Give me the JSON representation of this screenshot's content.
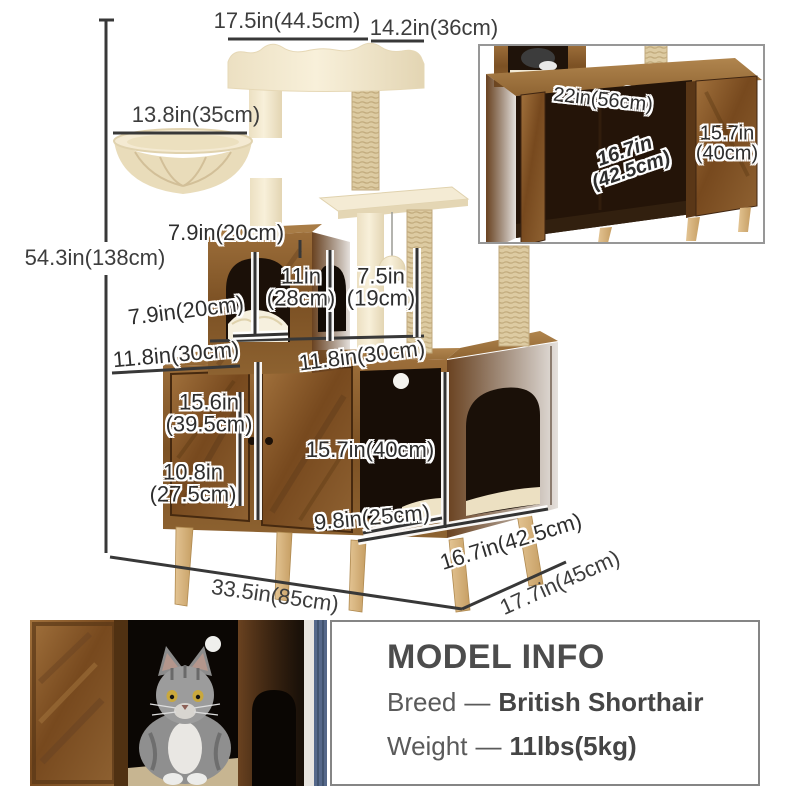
{
  "diagram": {
    "dimensions": {
      "top_platform_width": "17.5in(44.5cm)",
      "top_platform_depth": "14.2in(36cm)",
      "hammock_width": "13.8in(35cm)",
      "total_height": "54.3in(138cm)",
      "condo_height": "7.9in(20cm)",
      "condo_interior_height": {
        "line1": "11in",
        "line2": "(28cm)"
      },
      "post_section_height": {
        "line1": "7.5in",
        "line2": "(19cm)"
      },
      "condo_depth": "7.9in(20cm)",
      "top_depth_left": "11.8in(30cm)",
      "top_depth_right": "11.8in(30cm)",
      "left_door_height": {
        "line1": "15.6in",
        "line2": "(39.5cm)"
      },
      "lower_section_height": {
        "line1": "10.8in",
        "line2": "(27.5cm)"
      },
      "side_opening_height": "15.7in(40cm)",
      "cushion_width": "9.8in(25cm)",
      "base_width": "33.5in(85cm)",
      "base_depth": "17.7in(45cm)",
      "base_side_depth": "16.7in(42.5cm)"
    },
    "inset": {
      "opening_width": "22in(56cm)",
      "interior_depth": {
        "line1": "16.7in",
        "line2": "(42.5cm)"
      },
      "door_height": {
        "line1": "15.7in",
        "line2": "(40cm)"
      }
    }
  },
  "model_info": {
    "title": "MODEL INFO",
    "breed_label": "Breed",
    "breed_separator": "—",
    "breed_value": "British Shorthair",
    "weight_label": "Weight",
    "weight_separator": "—",
    "weight_value": "11lbs(5kg)"
  },
  "colors": {
    "wood": "#8a5c2e",
    "plush": "#f4ead2",
    "dimension_text": "#3d3d3d",
    "info_text": "#4c4c4c",
    "panel_border": "#858585"
  }
}
